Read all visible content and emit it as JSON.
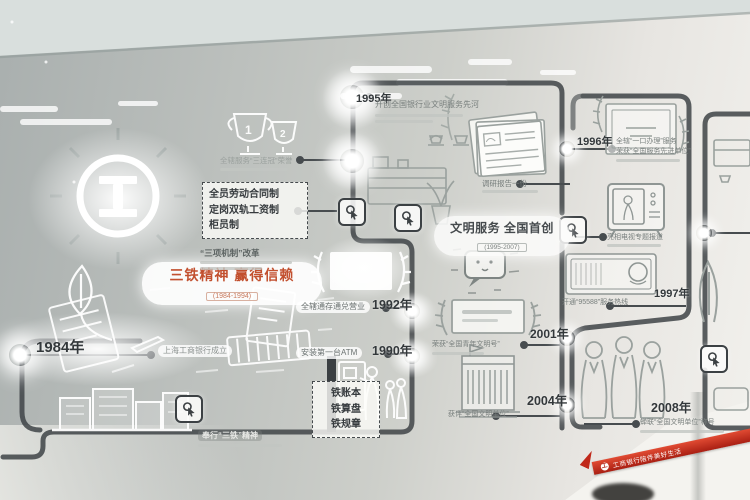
{
  "wall": {
    "line_color": "#3f4447",
    "accent_red": "#c2502f",
    "panel_text": "#4a4f52",
    "ceiling": "#d9dfdd"
  },
  "logo": {
    "name": "ICBC 工商银行标志"
  },
  "themes": {
    "santie": {
      "title": "三铁精神 赢得信赖",
      "dates": "(1984-1994)"
    },
    "wenming": {
      "title": "文明服务 全国首创",
      "dates": "(1995-2007)"
    }
  },
  "boxes": {
    "reform": {
      "line1": "全员劳动合同制",
      "line2": "定岗双轨工资制",
      "line3": "柜员制",
      "caption": "“三项机制”改革"
    },
    "irons": {
      "line1": "铁账本",
      "line2": "铁算盘",
      "line3": "铁规章",
      "caption": "奉行“三铁”精神"
    }
  },
  "milestones": {
    "m1984": {
      "year": "1984年",
      "caption": "上海工商银行成立"
    },
    "m1990": {
      "year": "1990年",
      "caption": "安装第一台ATM"
    },
    "m1992": {
      "year": "1992年",
      "caption": "全辖通存通兑营业"
    },
    "m1995": {
      "year": "1995年",
      "caption": "开创全国银行业文明服务先河"
    },
    "m1996": {
      "year": "1996年",
      "caption1": "全辖“一口办理”服务",
      "caption2": "荣获“全国服务先进单位”"
    },
    "m1997": {
      "year": "1997年",
      "caption": "开通“95588”服务热线"
    },
    "m2001": {
      "year": "2001年",
      "caption": "荣获“全国青年文明号”"
    },
    "m2004": {
      "year": "2004年",
      "caption": "获评“全国文明单位”"
    },
    "m2008": {
      "year": "2008年",
      "caption": "蝉联“全国文明单位”称号"
    }
  },
  "captions": {
    "trophies": "全辖服务“三连冠”荣誉",
    "docs": "调研报告一份",
    "tv": "亮相电视专题报道"
  },
  "ribbon": {
    "text": "工商银行陪伴美好生活",
    "brand": "工"
  }
}
